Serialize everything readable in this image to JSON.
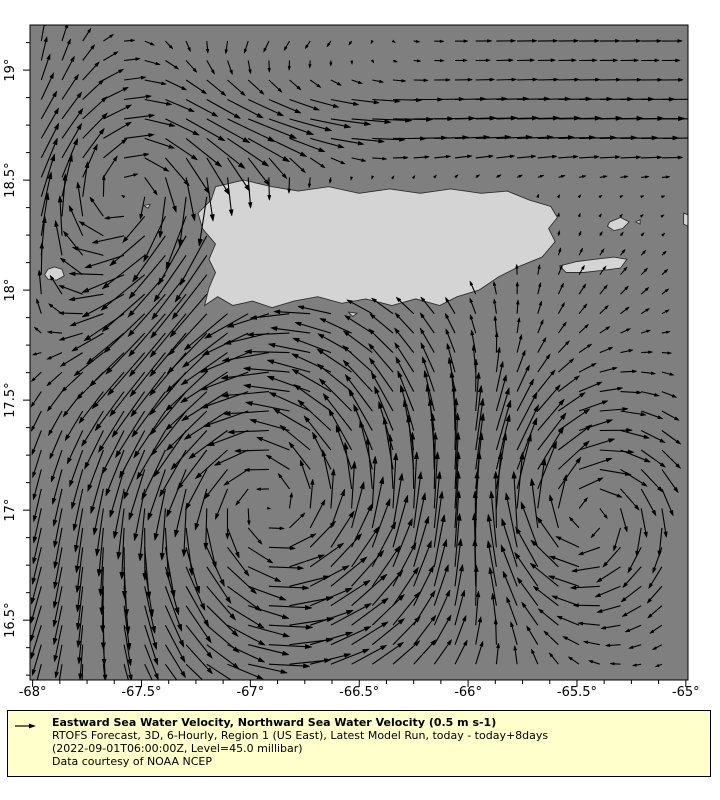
{
  "legend": {
    "title": "Eastward Sea Water Velocity, Northward Sea Water Velocity (0.5 m s-1)",
    "lines": [
      "RTOFS Forecast, 3D, 6-Hourly, Region 1 (US East), Latest Model Run, today - today+8days",
      "(2022-09-01T06:00:00Z, Level=45.0 millibar)",
      "Data courtesy of NOAA NCEP"
    ],
    "box": {
      "left": 7,
      "top": 710,
      "width": 704,
      "height": 67,
      "bg": "#ffffcc",
      "border": "#000000"
    },
    "arrow_len_px": 22
  },
  "chart_data": {
    "type": "quiver",
    "title": "Eastward Sea Water Velocity, Northward Sea Water Velocity",
    "reference_vector": {
      "value": 0.5,
      "unit": "m s-1"
    },
    "colors": {
      "ocean": "#7f7f7f",
      "land": "#d4d4d4",
      "coast": "#2e2e2e",
      "arrow": "#000000",
      "frame": "#000000",
      "tick_label": "#000000"
    },
    "layout": {
      "left": 30,
      "top": 25,
      "right": 688,
      "bottom": 680,
      "lon_min": -68.012,
      "lon_max": -64.99,
      "lat_min": 16.228,
      "lat_max": 19.205,
      "tick_len_major": 7,
      "tick_len_minor": 4,
      "minor_step": 0.125,
      "tick_label_size": 13,
      "x_label_y": 696,
      "y_label_x": 14
    },
    "axes": {
      "x": {
        "ticks": [
          {
            "v": -68,
            "label": "-68°"
          },
          {
            "v": -67.5,
            "label": "-67.5°"
          },
          {
            "v": -67,
            "label": "-67°"
          },
          {
            "v": -66.5,
            "label": "-66.5°"
          },
          {
            "v": -66,
            "label": "-66°"
          },
          {
            "v": -65.5,
            "label": "-65.5°"
          },
          {
            "v": -65,
            "label": "-65°"
          }
        ]
      },
      "y": {
        "ticks": [
          {
            "v": 19,
            "label": "19°"
          },
          {
            "v": 18.5,
            "label": "18.5°"
          },
          {
            "v": 18,
            "label": "18°"
          },
          {
            "v": 17.5,
            "label": "17.5°"
          },
          {
            "v": 17,
            "label": "17°"
          },
          {
            "v": 16.5,
            "label": "16.5°"
          }
        ]
      }
    },
    "grid": {
      "lon_start": -67.96,
      "lon_step": 0.095,
      "cols": 31,
      "lat_start": 16.3,
      "lat_step": 0.0885,
      "rows": 33
    },
    "arrow_scale_px_per_ms": 42,
    "speed_cap_ms": 1.35,
    "features": [
      {
        "type": "drift",
        "u": 0.05,
        "v": 0.0,
        "cx": -66.5,
        "cy": 17.7,
        "sx": 99,
        "sy": 99
      },
      {
        "type": "jet_u",
        "amp": 1.0,
        "lat0": 18.76,
        "sigma": 0.18,
        "ramp_from": -67.45,
        "ramp_to": -67.05
      },
      {
        "type": "jet_u",
        "amp": 0.45,
        "lat0": 19.18,
        "sigma": 0.22,
        "ramp_from": -66.45,
        "ramp_to": -65.85
      },
      {
        "type": "vortex",
        "dir": -1,
        "cx": -67.52,
        "cy": 18.42,
        "R": 0.42,
        "S": 0.75
      },
      {
        "type": "vortex",
        "dir": 1,
        "cx": -66.92,
        "cy": 17.02,
        "R": 0.7,
        "S": 1.05
      },
      {
        "type": "vortex",
        "dir": -1,
        "cx": -65.5,
        "cy": 16.98,
        "R": 0.4,
        "S": 0.8
      },
      {
        "type": "drift",
        "u": -0.55,
        "v": -0.32,
        "cx": -67.9,
        "cy": 16.5,
        "sx": 0.8,
        "sy": 0.55
      },
      {
        "type": "drift",
        "u": -0.3,
        "v": -0.18,
        "cx": -67.05,
        "cy": 19.2,
        "sx": 0.55,
        "sy": 0.3
      },
      {
        "type": "drift",
        "u": -0.15,
        "v": 0.4,
        "cx": -67.97,
        "cy": 19.05,
        "sx": 0.3,
        "sy": 0.3
      },
      {
        "type": "drift",
        "u": 0.1,
        "v": 0.14,
        "cx": -65.35,
        "cy": 18.02,
        "sx": 0.5,
        "sy": 0.22
      },
      {
        "type": "drift",
        "u": 0.12,
        "v": -0.8,
        "cx": -67.33,
        "cy": 17.95,
        "sx": 0.3,
        "sy": 0.55
      },
      {
        "type": "drift",
        "u": 0.55,
        "v": 0.55,
        "cx": -68.0,
        "cy": 18.15,
        "sx": 0.3,
        "sy": 0.45
      }
    ],
    "land": {
      "puerto_rico": [
        [
          -67.16,
          18.47
        ],
        [
          -67.03,
          18.5
        ],
        [
          -66.9,
          18.47
        ],
        [
          -66.78,
          18.45
        ],
        [
          -66.64,
          18.47
        ],
        [
          -66.5,
          18.44
        ],
        [
          -66.36,
          18.46
        ],
        [
          -66.22,
          18.44
        ],
        [
          -66.08,
          18.46
        ],
        [
          -65.94,
          18.44
        ],
        [
          -65.82,
          18.45
        ],
        [
          -65.72,
          18.41
        ],
        [
          -65.62,
          18.38
        ],
        [
          -65.59,
          18.33
        ],
        [
          -65.63,
          18.28
        ],
        [
          -65.6,
          18.22
        ],
        [
          -65.66,
          18.15
        ],
        [
          -65.76,
          18.11
        ],
        [
          -65.86,
          18.06
        ],
        [
          -65.95,
          18.0
        ],
        [
          -66.05,
          17.97
        ],
        [
          -66.13,
          17.93
        ],
        [
          -66.24,
          17.96
        ],
        [
          -66.35,
          17.93
        ],
        [
          -66.47,
          17.96
        ],
        [
          -66.58,
          17.94
        ],
        [
          -66.69,
          17.97
        ],
        [
          -66.8,
          17.95
        ],
        [
          -66.9,
          17.92
        ],
        [
          -66.99,
          17.95
        ],
        [
          -67.08,
          17.93
        ],
        [
          -67.15,
          17.97
        ],
        [
          -67.21,
          17.93
        ],
        [
          -67.19,
          18.01
        ],
        [
          -67.16,
          18.08
        ],
        [
          -67.19,
          18.14
        ],
        [
          -67.16,
          18.21
        ],
        [
          -67.22,
          18.28
        ],
        [
          -67.24,
          18.35
        ],
        [
          -67.18,
          18.41
        ]
      ],
      "vieques": [
        [
          -65.58,
          18.11
        ],
        [
          -65.5,
          18.13
        ],
        [
          -65.42,
          18.14
        ],
        [
          -65.33,
          18.15
        ],
        [
          -65.27,
          18.14
        ],
        [
          -65.3,
          18.1
        ],
        [
          -65.38,
          18.09
        ],
        [
          -65.47,
          18.08
        ],
        [
          -65.55,
          18.08
        ]
      ],
      "culebra": [
        [
          -65.35,
          18.31
        ],
        [
          -65.3,
          18.33
        ],
        [
          -65.26,
          18.31
        ],
        [
          -65.29,
          18.28
        ],
        [
          -65.33,
          18.27
        ],
        [
          -65.36,
          18.29
        ]
      ],
      "culebrita": [
        [
          -65.23,
          18.31
        ],
        [
          -65.21,
          18.32
        ],
        [
          -65.21,
          18.3
        ]
      ],
      "mona": [
        [
          -67.945,
          18.07
        ],
        [
          -67.93,
          18.095
        ],
        [
          -67.9,
          18.105
        ],
        [
          -67.865,
          18.095
        ],
        [
          -67.855,
          18.065
        ],
        [
          -67.89,
          18.045
        ],
        [
          -67.93,
          18.05
        ]
      ],
      "desecheo": [
        [
          -67.49,
          18.385
        ],
        [
          -67.46,
          18.39
        ],
        [
          -67.47,
          18.372
        ]
      ],
      "caja_de_muertos": [
        [
          -66.55,
          17.9
        ],
        [
          -66.51,
          17.895
        ],
        [
          -66.53,
          17.88
        ]
      ],
      "st_thomas_tip": [
        [
          -65.01,
          18.35
        ],
        [
          -64.96,
          18.33
        ],
        [
          -64.97,
          18.28
        ],
        [
          -65.01,
          18.3
        ]
      ]
    }
  }
}
